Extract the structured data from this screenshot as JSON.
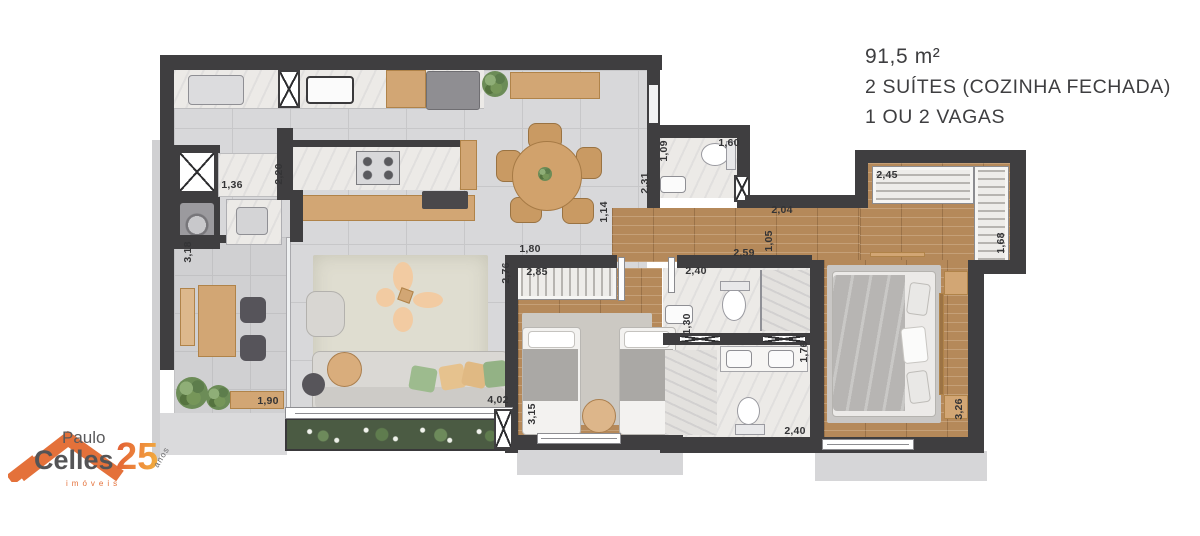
{
  "info_panel": {
    "area": "91,5 m²",
    "suites": "2 SUÍTES (COZINHA FECHADA)",
    "vagas": "1 OU 2 VAGAS"
  },
  "logo": {
    "first_name": "Paulo",
    "last_name": "Celles",
    "tagline": "imóveis",
    "years": "25",
    "years_label": "anos"
  },
  "colors": {
    "wall": "#3f3e40",
    "wood_floor": "#b5895a",
    "accent_orange": "#e4713a",
    "text": "#3e3e40"
  },
  "floorplan": {
    "dimensions": [
      {
        "label": "1,36",
        "x": 72,
        "y": 130,
        "vertical": false
      },
      {
        "label": "2,20",
        "x": 119,
        "y": 119,
        "vertical": true
      },
      {
        "label": "3,18",
        "x": 28,
        "y": 197,
        "vertical": true
      },
      {
        "label": "1,90",
        "x": 108,
        "y": 346,
        "vertical": false
      },
      {
        "label": "2,76",
        "x": 346,
        "y": 218,
        "vertical": true
      },
      {
        "label": "1,80",
        "x": 370,
        "y": 194,
        "vertical": false
      },
      {
        "label": "2,85",
        "x": 377,
        "y": 217,
        "vertical": false
      },
      {
        "label": "4,02",
        "x": 338,
        "y": 345,
        "vertical": false
      },
      {
        "label": "3,15",
        "x": 372,
        "y": 359,
        "vertical": true
      },
      {
        "label": "1,14",
        "x": 444,
        "y": 157,
        "vertical": true
      },
      {
        "label": "2,31",
        "x": 485,
        "y": 128,
        "vertical": true
      },
      {
        "label": "1,09",
        "x": 504,
        "y": 96,
        "vertical": true
      },
      {
        "label": "1,60",
        "x": 569,
        "y": 88,
        "vertical": false
      },
      {
        "label": "2,04",
        "x": 622,
        "y": 155,
        "vertical": false
      },
      {
        "label": "1,05",
        "x": 609,
        "y": 186,
        "vertical": true
      },
      {
        "label": "2,59",
        "x": 584,
        "y": 198,
        "vertical": false
      },
      {
        "label": "2,40",
        "x": 536,
        "y": 216,
        "vertical": false
      },
      {
        "label": "1,30",
        "x": 527,
        "y": 269,
        "vertical": true
      },
      {
        "label": "1,76",
        "x": 644,
        "y": 297,
        "vertical": true
      },
      {
        "label": "2,40",
        "x": 635,
        "y": 376,
        "vertical": false
      },
      {
        "label": "2,45",
        "x": 727,
        "y": 120,
        "vertical": false
      },
      {
        "label": "1,68",
        "x": 841,
        "y": 188,
        "vertical": true
      },
      {
        "label": "3,26",
        "x": 799,
        "y": 354,
        "vertical": true
      }
    ]
  }
}
